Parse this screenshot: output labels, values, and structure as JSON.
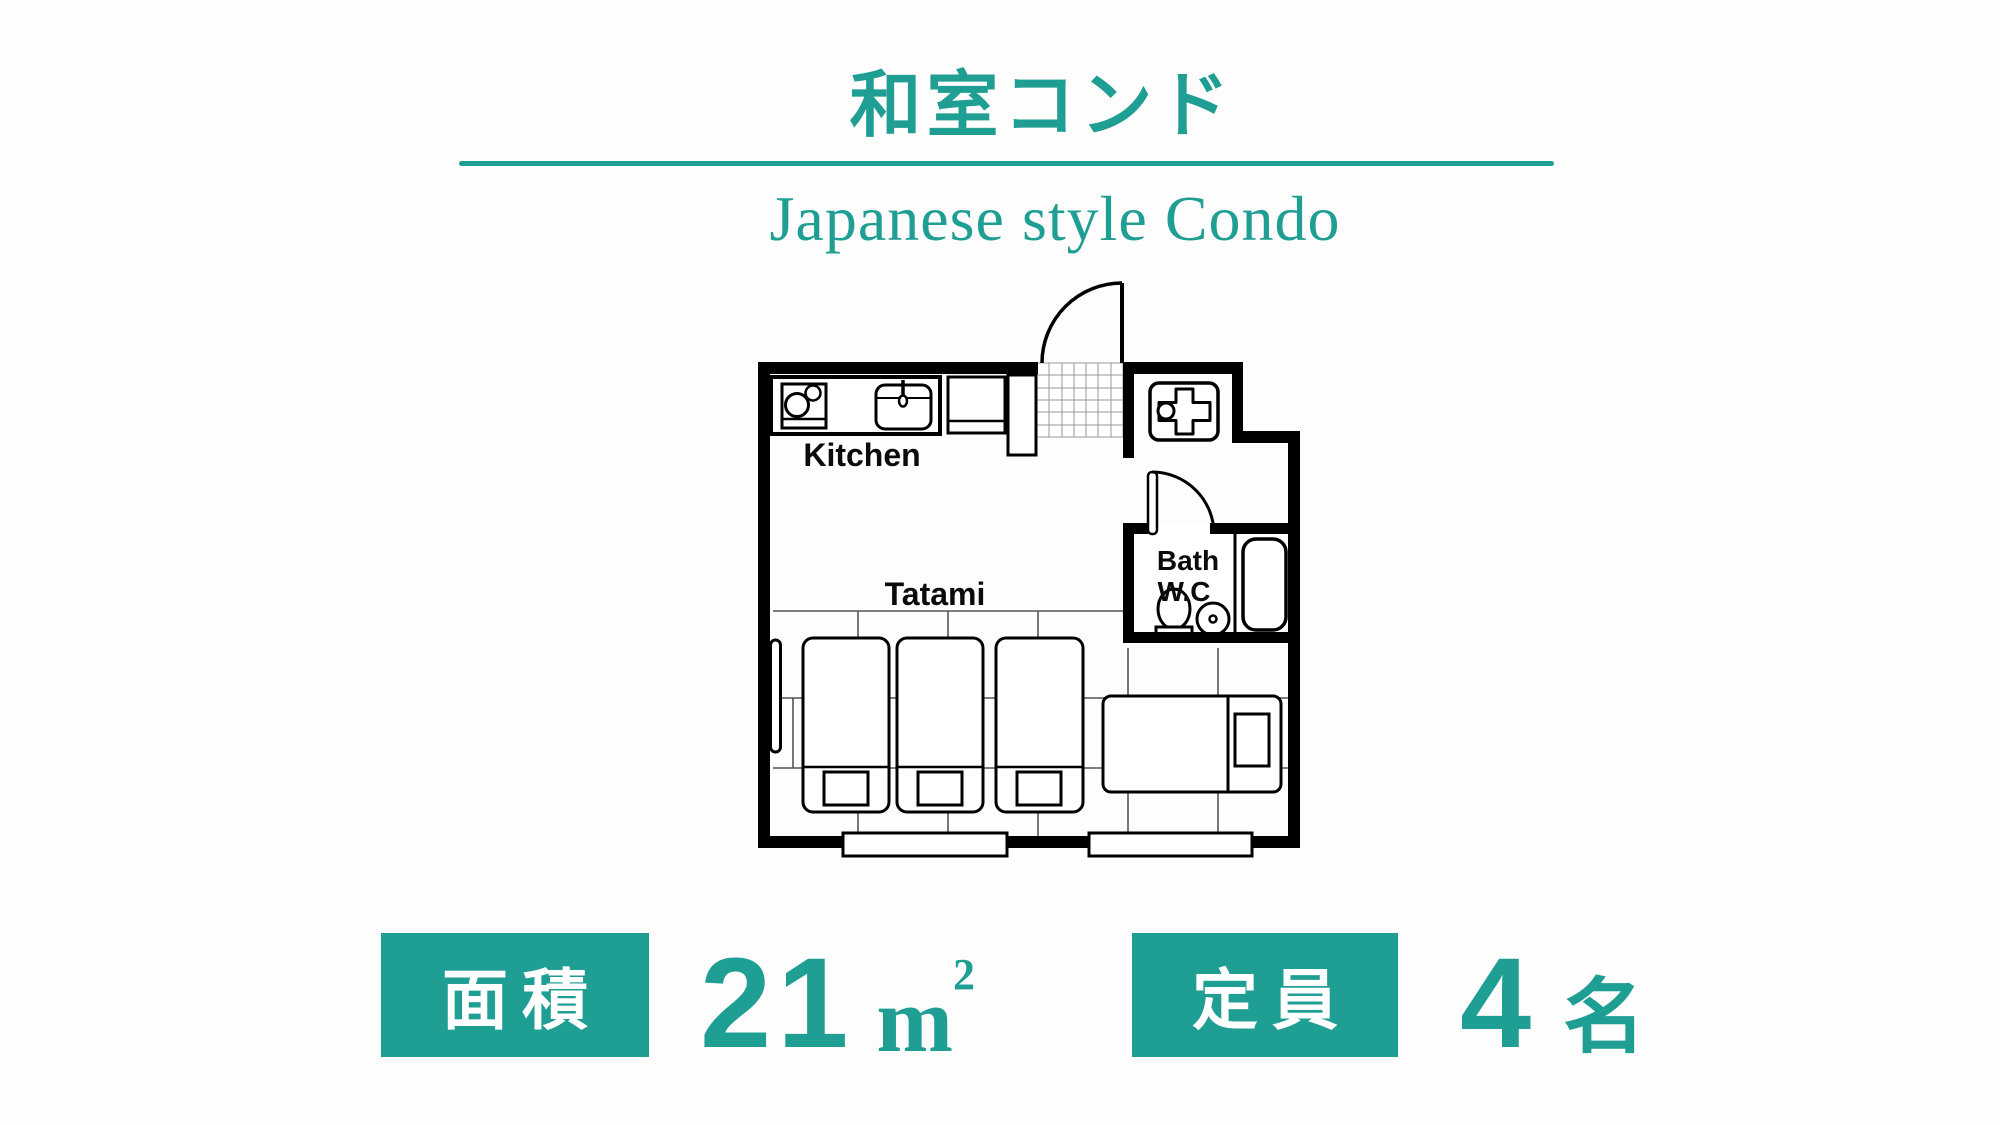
{
  "header": {
    "title": "和室コンド",
    "subtitle": "Japanese style Condo"
  },
  "floorplan": {
    "labels": {
      "kitchen": "Kitchen",
      "tatami": "Tatami",
      "bath_line1": "Bath",
      "bath_line2": "W.C"
    }
  },
  "info": {
    "area": {
      "label": "面積",
      "value": "21",
      "unit_base": "m",
      "unit_exponent": "2"
    },
    "capacity": {
      "label": "定員",
      "value": "4",
      "unit": "名"
    }
  },
  "colors": {
    "accent": "#1f9e93",
    "wall": "#000000",
    "background": "#fdfdfd"
  }
}
